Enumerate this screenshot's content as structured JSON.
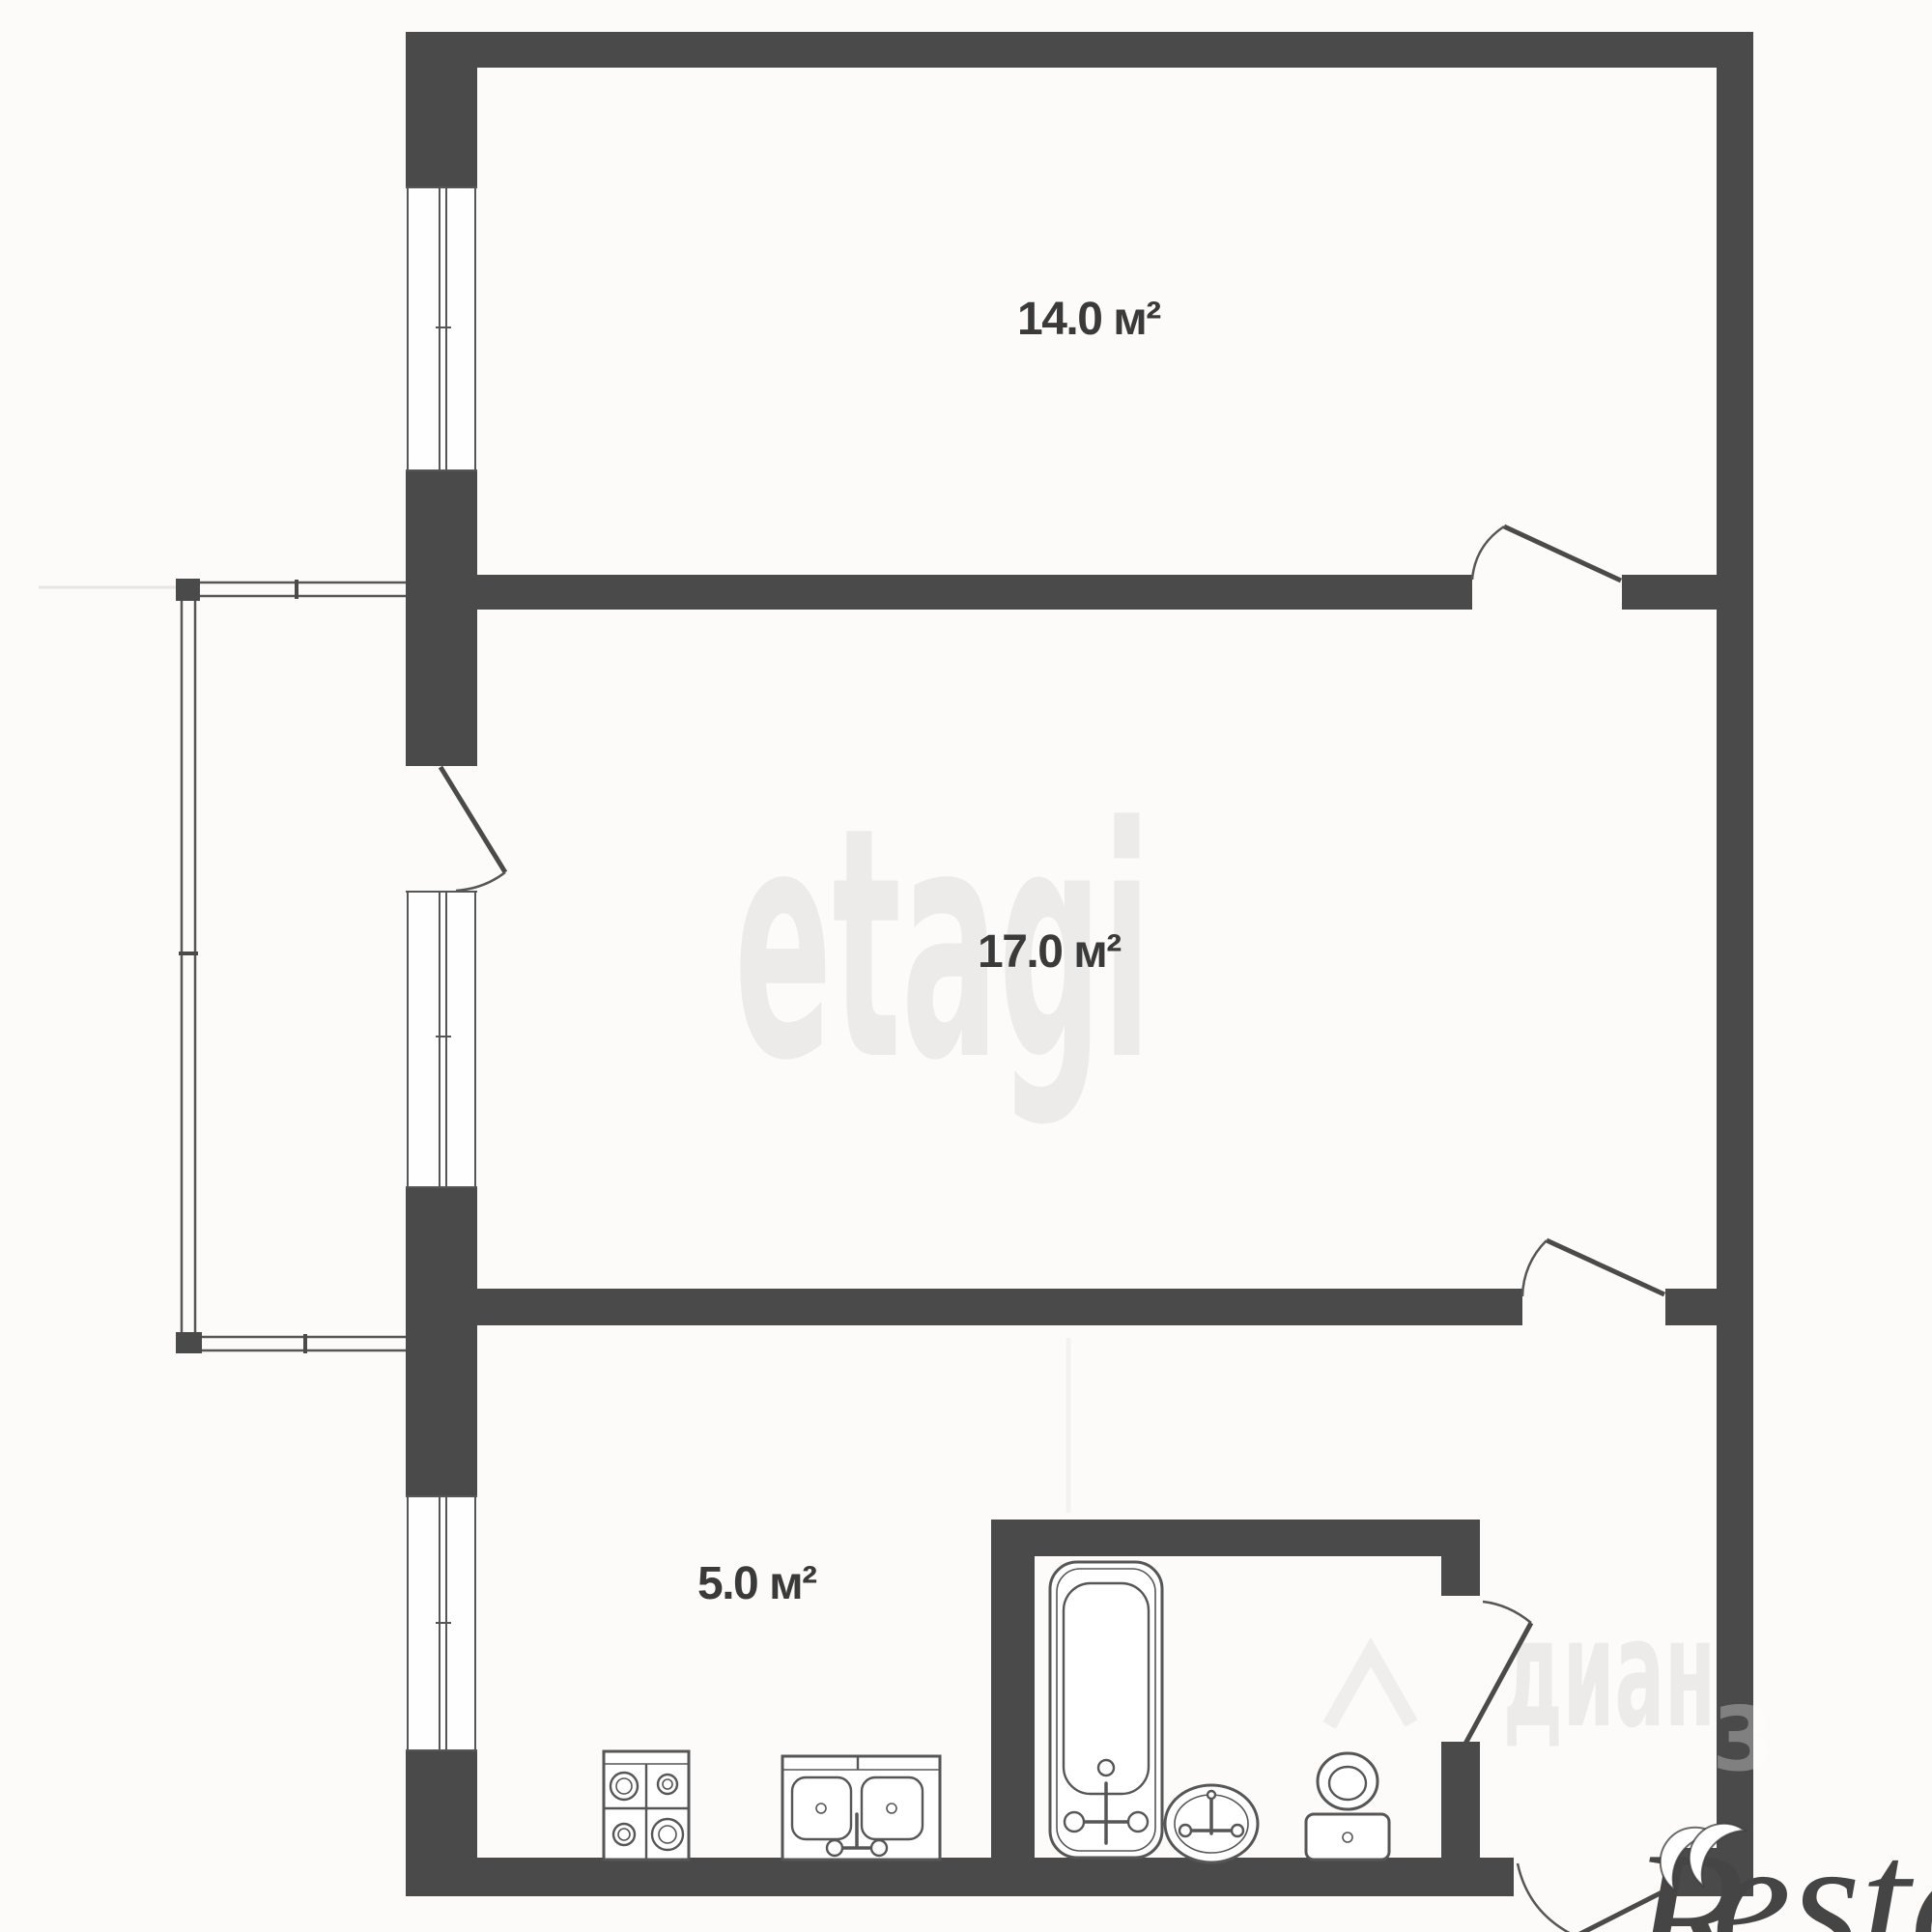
{
  "plan": {
    "type": "apartment-floor-plan",
    "rooms": [
      {
        "id": "room-14",
        "area_label": "14.0 м²"
      },
      {
        "id": "room-17",
        "area_label": "17.0 м²"
      },
      {
        "id": "kitchen",
        "area_label": "5.0 м²"
      }
    ],
    "fixtures": {
      "stove": "stove-4-burners-icon",
      "kitchen_sink": "double-sink-icon",
      "bathtub": "bathtub-icon",
      "bath_sink": "oval-sink-icon",
      "toilet": "toilet-icon"
    },
    "features": [
      "balcony",
      "3 windows",
      "5 doors"
    ]
  },
  "watermarks": {
    "etagi": "etagi",
    "cian_text": "диан",
    "cian_digit": "3",
    "restate_r": "R",
    "restate_rest": "estate"
  },
  "colors": {
    "wall": "#4a4a4b",
    "line": "#565656",
    "label": "#3a3a3a",
    "wm_light": "#ecebea",
    "wm_dark": "#454545",
    "bg": "#fcfbfa"
  }
}
